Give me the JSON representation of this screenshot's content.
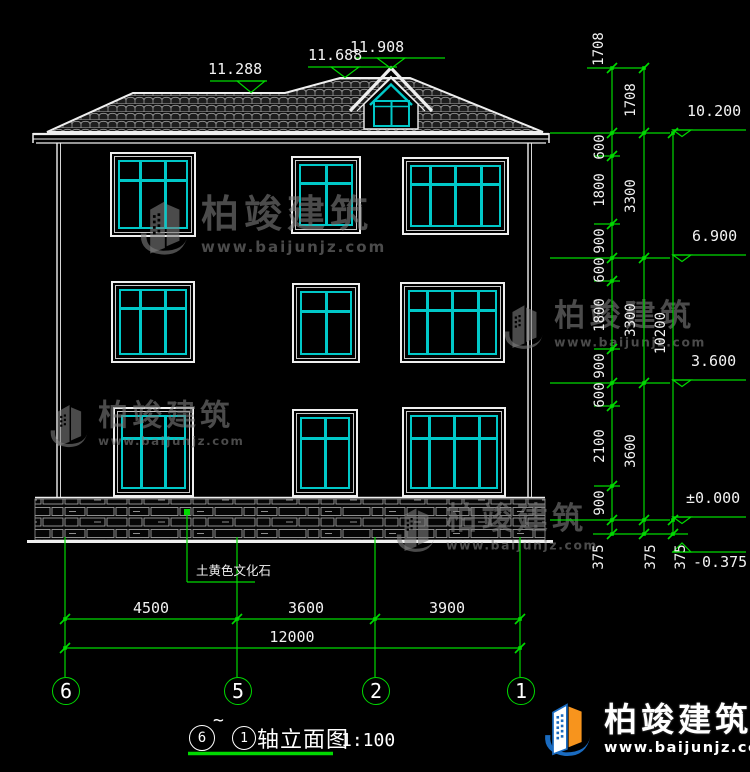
{
  "title_block": {
    "axis_from": "6",
    "tilde": "~",
    "axis_to": "1",
    "name": "轴立面图",
    "scale": "1:100"
  },
  "elevations": {
    "top": [
      "11.288",
      "11.688",
      "11.908"
    ],
    "right": [
      "10.200",
      "6.900",
      "3.600",
      "±0.000",
      "-0.375"
    ]
  },
  "dims": {
    "chain_inner": [
      "1708",
      "600",
      "1800",
      "900",
      "600",
      "1800",
      "900",
      "600",
      "2100",
      "900",
      "375"
    ],
    "chain_mid": [
      "1708",
      "3300",
      "3300",
      "3600",
      "375"
    ],
    "chain_outer": [
      "10200",
      "375"
    ],
    "bottom": [
      "4500",
      "3600",
      "3900"
    ],
    "total": "12000"
  },
  "axes": {
    "bubbles": [
      "6",
      "5",
      "2",
      "1"
    ]
  },
  "notes": {
    "material": "土黄色文化石"
  },
  "brand": {
    "name": "柏竣建筑",
    "url": "www.baijunjz.com"
  },
  "colors": {
    "background": "#000000",
    "line": "#ffffff",
    "dimension_green": "#00d900",
    "window_cyan": "#00c8c8",
    "logo_blue": "#1a6bc0",
    "logo_orange": "#f7941d",
    "watermark_gray": "#7d7d7d"
  }
}
